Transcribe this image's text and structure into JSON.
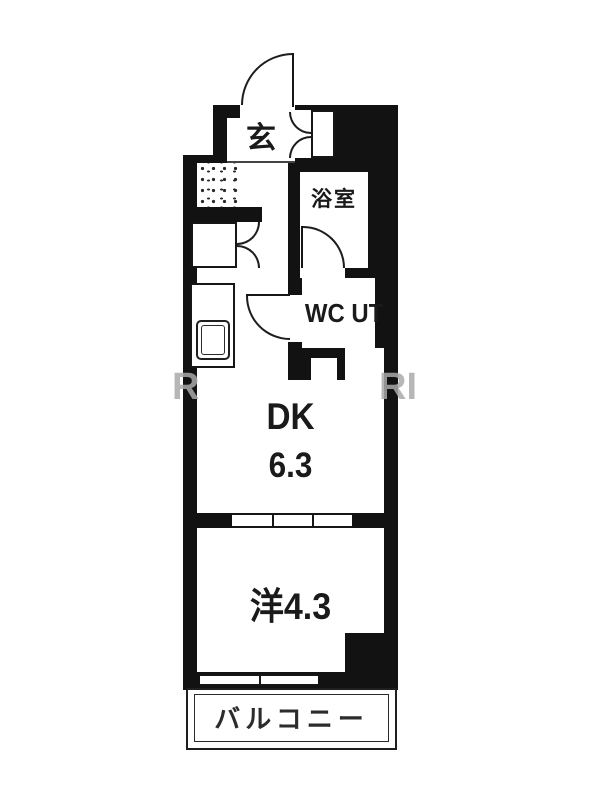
{
  "floorplan": {
    "entrance_label": "玄",
    "bathroom_label": "浴室",
    "wc_ut_label": "WC UT",
    "dk_label": "DK",
    "dk_size": "6.3",
    "western_room_label": "洋4.3",
    "balcony_label": "バルコニー",
    "watermark_left": "R",
    "watermark_right": "RI",
    "colors": {
      "wall": "#121212",
      "floor": "#ffffff"
    }
  }
}
